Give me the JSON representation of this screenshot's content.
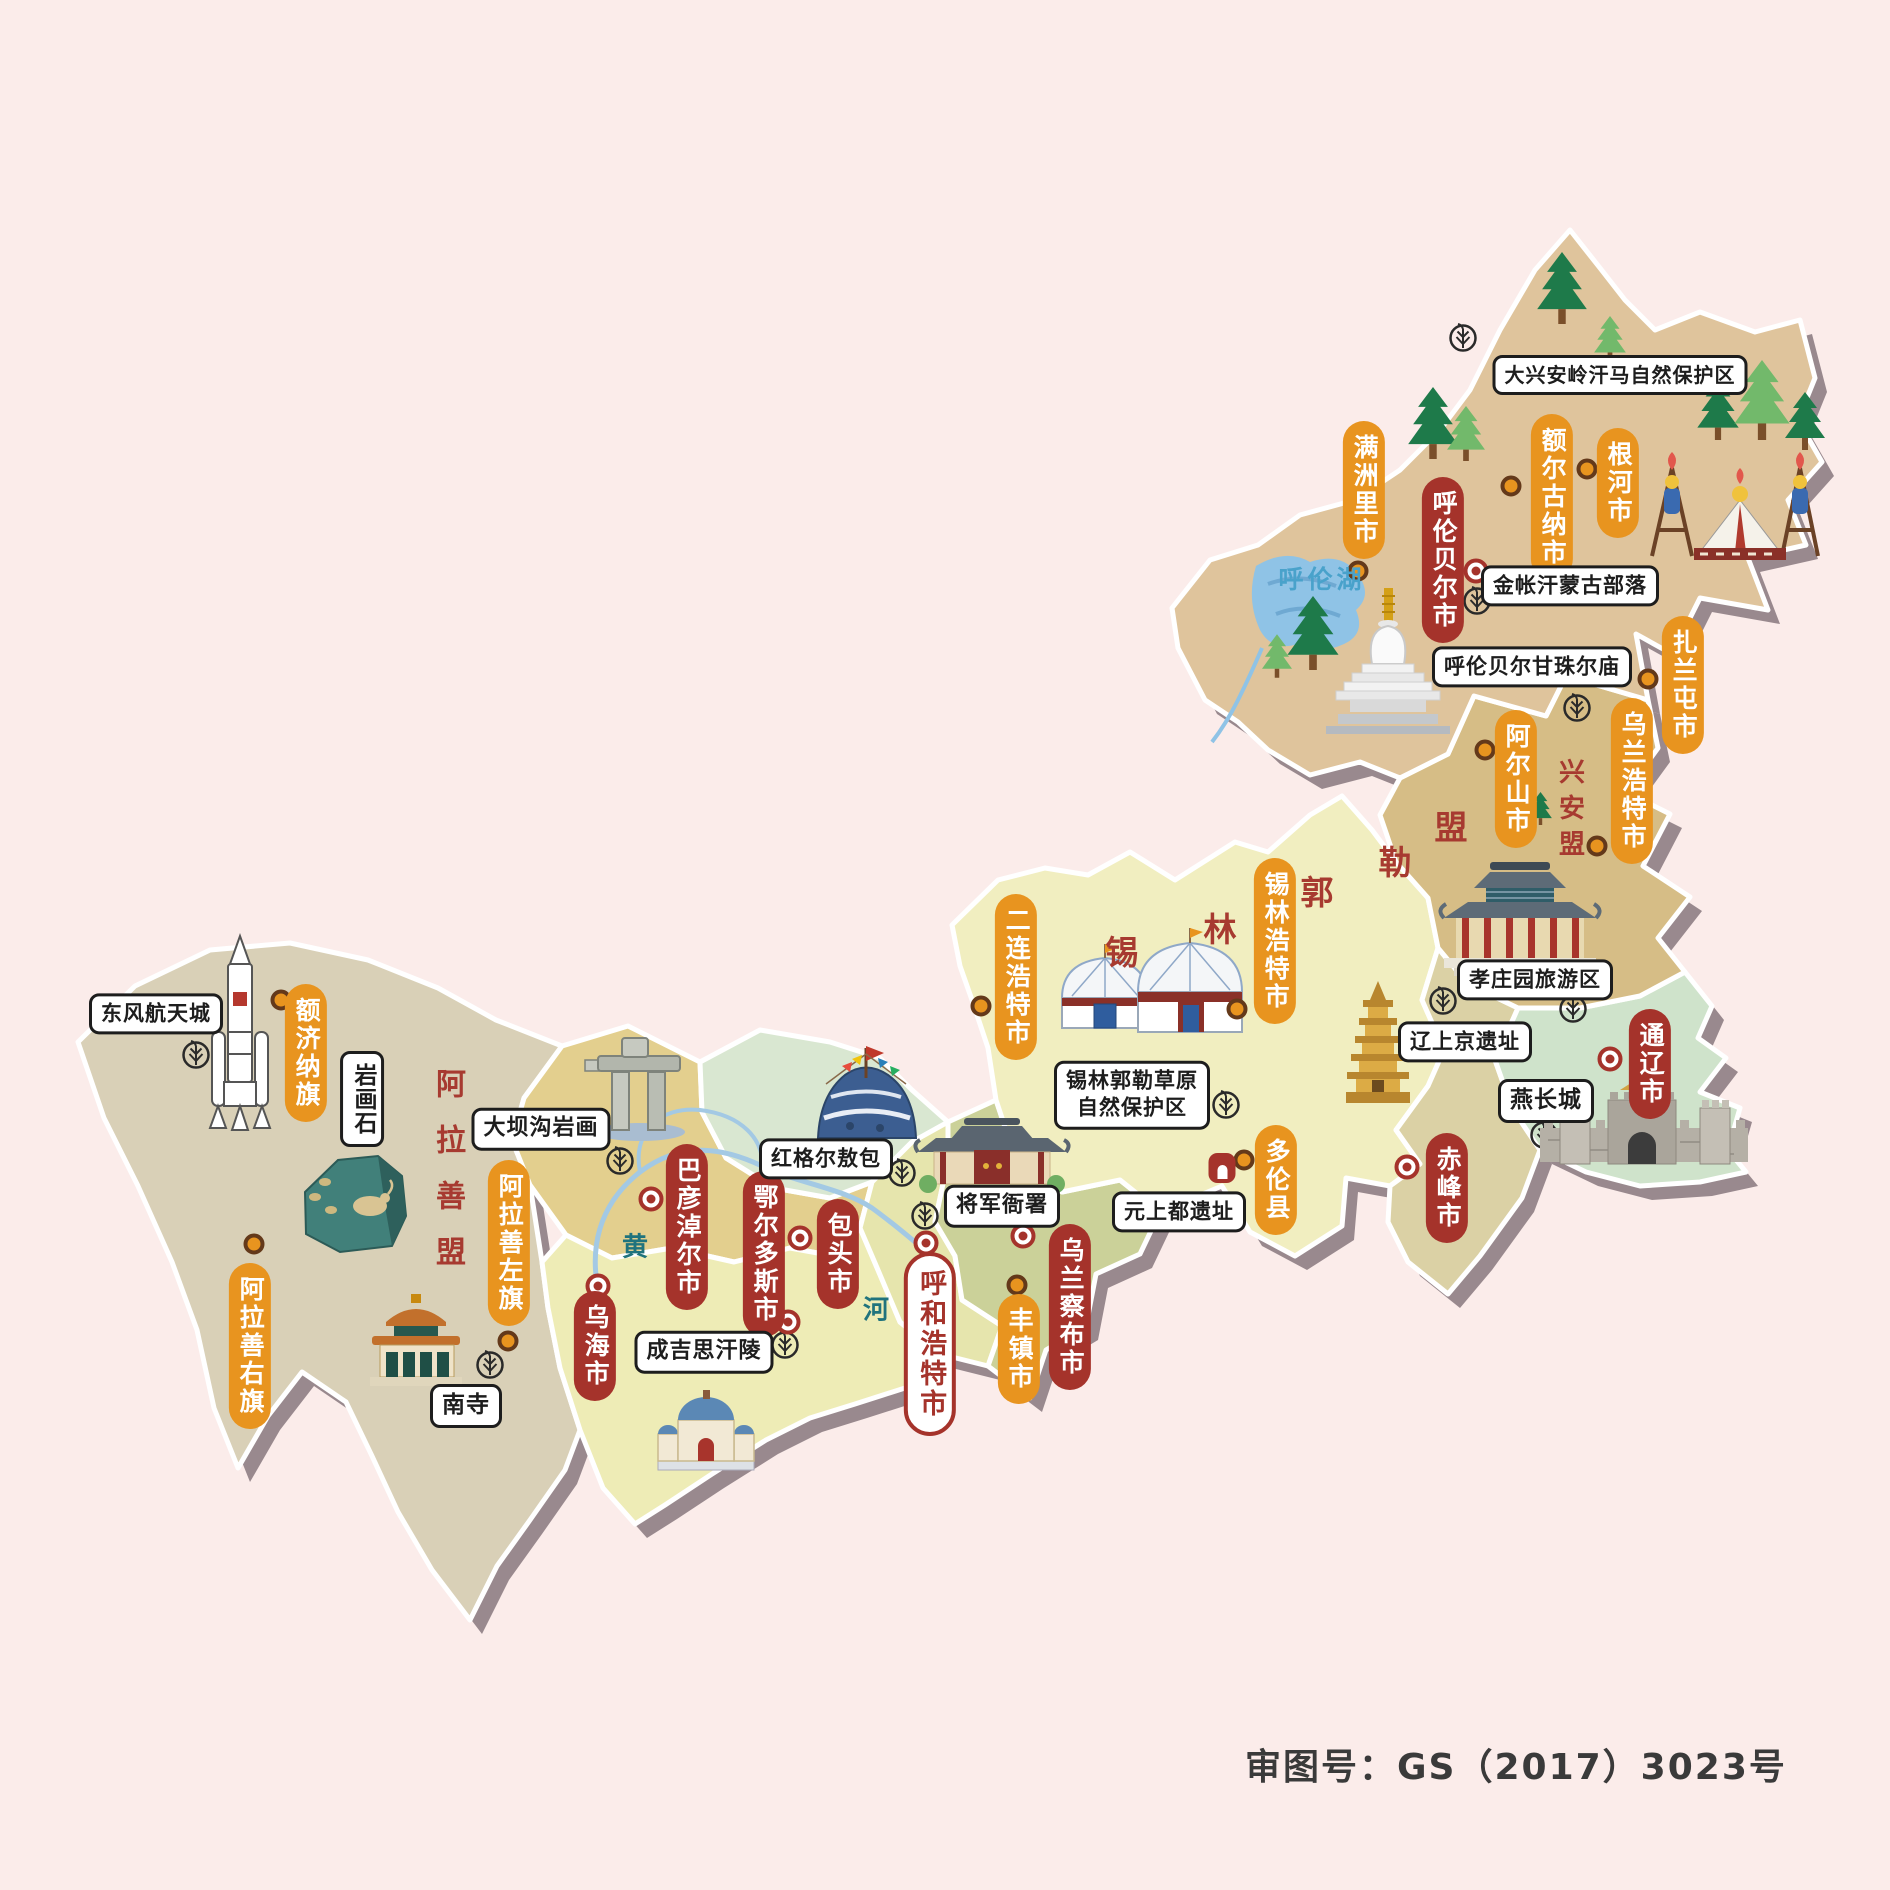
{
  "palette": {
    "bg": "#fbecea",
    "shadow": "#99898e",
    "pill_minor": "#e8941f",
    "pill_major": "#a5332b",
    "region_label": "#a73a30",
    "r_hulunbuir": "#dfc49c",
    "r_xingan": "#d6bd86",
    "r_xilinguole": "#f1eec0",
    "r_tongliao": "#cfe3cb",
    "r_chifeng": "#dbd1a5",
    "r_ulanqab": "#cbd199",
    "r_hohhot": "#e6e5ad",
    "r_midgreen": "#d9e7d1",
    "r_bayannur": "#e3cf8e",
    "r_ordos": "#eeecb6",
    "r_alxa": "#d9d0b7"
  },
  "footer": {
    "text": "审图号：GS（2017）3023号"
  },
  "labels": [
    {
      "id": "city-pill-manzhouli",
      "text": "满洲里市",
      "kind": "pill-minor",
      "x": 1364,
      "y": 490
    },
    {
      "id": "city-pill-eerguna",
      "text": "额尔古纳市",
      "kind": "pill-minor",
      "x": 1552,
      "y": 497
    },
    {
      "id": "city-pill-genhe",
      "text": "根河市",
      "kind": "pill-minor",
      "x": 1618,
      "y": 483
    },
    {
      "id": "city-pill-hulunbeier",
      "text": "呼伦贝尔市",
      "kind": "pill-major",
      "x": 1443,
      "y": 560
    },
    {
      "id": "city-pill-zhalantun",
      "text": "扎兰屯市",
      "kind": "pill-minor",
      "x": 1683,
      "y": 685
    },
    {
      "id": "city-pill-wulanhaote",
      "text": "乌兰浩特市",
      "kind": "pill-minor",
      "x": 1632,
      "y": 781
    },
    {
      "id": "city-pill-aershan",
      "text": "阿尔山市",
      "kind": "pill-minor",
      "x": 1516,
      "y": 779
    },
    {
      "id": "city-pill-erlianhaote",
      "text": "二连浩特市",
      "kind": "pill-minor",
      "x": 1016,
      "y": 977
    },
    {
      "id": "city-pill-xilinhaote",
      "text": "锡林浩特市",
      "kind": "pill-minor",
      "x": 1275,
      "y": 941
    },
    {
      "id": "city-pill-duolun",
      "text": "多伦县",
      "kind": "pill-minor",
      "x": 1276,
      "y": 1180
    },
    {
      "id": "city-pill-fengzhen",
      "text": "丰镇市",
      "kind": "pill-minor",
      "x": 1019,
      "y": 1349
    },
    {
      "id": "city-pill-ejina",
      "text": "额济纳旗",
      "kind": "pill-minor",
      "x": 306,
      "y": 1053
    },
    {
      "id": "city-pill-alashanzuoqi",
      "text": "阿拉善左旗",
      "kind": "pill-minor",
      "x": 509,
      "y": 1243
    },
    {
      "id": "city-pill-alashanyouqi",
      "text": "阿拉善右旗",
      "kind": "pill-minor",
      "x": 250,
      "y": 1346
    },
    {
      "id": "city-pill-wuhai",
      "text": "乌海市",
      "kind": "pill-major",
      "x": 595,
      "y": 1346
    },
    {
      "id": "city-pill-bayannaoer",
      "text": "巴彦淖尔市",
      "kind": "pill-major",
      "x": 687,
      "y": 1227
    },
    {
      "id": "city-pill-eerduosi",
      "text": "鄂尔多斯市",
      "kind": "pill-major",
      "x": 764,
      "y": 1254
    },
    {
      "id": "city-pill-baotou",
      "text": "包头市",
      "kind": "pill-major",
      "x": 838,
      "y": 1254
    },
    {
      "id": "city-pill-wulanchabu",
      "text": "乌兰察布市",
      "kind": "pill-major",
      "x": 1070,
      "y": 1307
    },
    {
      "id": "city-pill-chifeng",
      "text": "赤峰市",
      "kind": "pill-major",
      "x": 1447,
      "y": 1188
    },
    {
      "id": "city-pill-tongliao",
      "text": "通辽市",
      "kind": "pill-major",
      "x": 1650,
      "y": 1064
    },
    {
      "id": "city-pill-huhehaote",
      "text": "呼和浩特市",
      "kind": "pill-capital",
      "x": 930,
      "y": 1344
    },
    {
      "id": "site-box-hanma-reserve",
      "text": "大兴安岭汗马自然保护区",
      "kind": "box",
      "x": 1620,
      "y": 375,
      "size": 20
    },
    {
      "id": "site-box-jinzhanghan",
      "text": "金帐汗蒙古部落",
      "kind": "box",
      "x": 1570,
      "y": 586,
      "size": 21
    },
    {
      "id": "site-box-ganzhuer-temple",
      "text": "呼伦贝尔甘珠尔庙",
      "kind": "box",
      "x": 1532,
      "y": 667,
      "size": 21
    },
    {
      "id": "site-box-xiaozhuangyuan",
      "text": "孝庄园旅游区",
      "kind": "box",
      "x": 1535,
      "y": 980,
      "size": 21
    },
    {
      "id": "site-box-liaoshangjing",
      "text": "辽上京遗址",
      "kind": "box",
      "x": 1465,
      "y": 1042,
      "size": 21
    },
    {
      "id": "site-box-yanchangcheng",
      "text": "燕长城",
      "kind": "box",
      "x": 1546,
      "y": 1101
    },
    {
      "id": "site-box-ximeng-grassland",
      "text": "锡林郭勒草原\n自然保护区",
      "kind": "box",
      "x": 1132,
      "y": 1095,
      "size": 21
    },
    {
      "id": "site-box-yuanshangdu",
      "text": "元上都遗址",
      "kind": "box",
      "x": 1179,
      "y": 1212,
      "size": 21
    },
    {
      "id": "site-box-jiangjunyashu",
      "text": "将军衙署",
      "kind": "box",
      "x": 1002,
      "y": 1206,
      "size": 22
    },
    {
      "id": "site-box-honggeer-aobao",
      "text": "红格尔敖包",
      "kind": "box",
      "x": 826,
      "y": 1159,
      "size": 21
    },
    {
      "id": "site-box-chengjisihanling",
      "text": "成吉思汗陵",
      "kind": "box",
      "x": 704,
      "y": 1352,
      "size": 22
    },
    {
      "id": "site-box-nansi",
      "text": "南寺",
      "kind": "box",
      "x": 466,
      "y": 1406
    },
    {
      "id": "site-box-dabagou-rock-art",
      "text": "大坝沟岩画",
      "kind": "box",
      "x": 541,
      "y": 1129,
      "size": 22
    },
    {
      "id": "site-box-dongfeng-space-city",
      "text": "东风航天城",
      "kind": "box",
      "x": 156,
      "y": 1014,
      "size": 21
    },
    {
      "id": "site-box-yanhuashi",
      "text": "岩画石",
      "kind": "box-v",
      "x": 362,
      "y": 1099
    },
    {
      "id": "region-label-alashanmeng",
      "text": "阿拉善盟",
      "kind": "region-v",
      "x": 447,
      "y": 1180,
      "size": 30,
      "gap": 26
    },
    {
      "id": "region-label-xinganmeng",
      "text": "兴安盟",
      "kind": "region-v",
      "x": 1570,
      "y": 812,
      "size": 26,
      "gap": 10
    },
    {
      "id": "region-char-xi",
      "text": "锡",
      "kind": "region-char",
      "x": 1122,
      "y": 950
    },
    {
      "id": "region-char-lin",
      "text": "林",
      "kind": "region-char",
      "x": 1220,
      "y": 927
    },
    {
      "id": "region-char-guo",
      "text": "郭",
      "kind": "region-char",
      "x": 1317,
      "y": 890
    },
    {
      "id": "region-char-le",
      "text": "勒",
      "kind": "region-char",
      "x": 1395,
      "y": 860
    },
    {
      "id": "region-char-meng",
      "text": "盟",
      "kind": "region-char",
      "x": 1451,
      "y": 825
    },
    {
      "id": "water-label-hulun-lake",
      "text": "呼伦湖",
      "kind": "water",
      "x": 1322,
      "y": 578,
      "color": "#49a2cb",
      "size": 25
    },
    {
      "id": "water-label-huang",
      "text": "黄",
      "kind": "water",
      "x": 637,
      "y": 1245,
      "color": "#20737d",
      "size": 26
    },
    {
      "id": "water-label-he",
      "text": "河",
      "kind": "water",
      "x": 878,
      "y": 1308,
      "color": "#20737d",
      "size": 26
    }
  ],
  "markers": [
    {
      "id": "dot-manzhouli",
      "kind": "dot",
      "x": 1358,
      "y": 571
    },
    {
      "id": "dot-eerguna",
      "kind": "dot",
      "x": 1511,
      "y": 486
    },
    {
      "id": "dot-genhe",
      "kind": "dot",
      "x": 1587,
      "y": 469
    },
    {
      "id": "dot-zhalantun",
      "kind": "dot",
      "x": 1648,
      "y": 679
    },
    {
      "id": "dot-wulanhaote",
      "kind": "dot",
      "x": 1597,
      "y": 846
    },
    {
      "id": "dot-aershan",
      "kind": "dot",
      "x": 1485,
      "y": 750
    },
    {
      "id": "dot-xilinhaote",
      "kind": "dot",
      "x": 1237,
      "y": 1009
    },
    {
      "id": "dot-erlianhaote",
      "kind": "dot",
      "x": 981,
      "y": 1006
    },
    {
      "id": "dot-duolun",
      "kind": "dot",
      "x": 1244,
      "y": 1160
    },
    {
      "id": "dot-fengzhen",
      "kind": "dot",
      "x": 1017,
      "y": 1285
    },
    {
      "id": "dot-ejina",
      "kind": "dot",
      "x": 281,
      "y": 1000
    },
    {
      "id": "dot-alashanzuoqi",
      "kind": "dot",
      "x": 508,
      "y": 1341
    },
    {
      "id": "dot-alashanyouqi",
      "kind": "dot",
      "x": 254,
      "y": 1244
    },
    {
      "id": "capital-marker-hulunbeier",
      "kind": "cap",
      "x": 1476,
      "y": 571
    },
    {
      "id": "capital-marker-chifeng",
      "kind": "cap",
      "x": 1407,
      "y": 1167
    },
    {
      "id": "capital-marker-tongliao",
      "kind": "cap",
      "x": 1610,
      "y": 1059
    },
    {
      "id": "capital-marker-wulanchabu",
      "kind": "cap",
      "x": 1023,
      "y": 1236
    },
    {
      "id": "capital-marker-huhehaote",
      "kind": "cap",
      "x": 926,
      "y": 1243
    },
    {
      "id": "capital-marker-bayannaoer",
      "kind": "cap",
      "x": 651,
      "y": 1199
    },
    {
      "id": "capital-marker-baotou",
      "kind": "cap",
      "x": 800,
      "y": 1238
    },
    {
      "id": "capital-marker-eerduosi",
      "kind": "cap",
      "x": 788,
      "y": 1322
    },
    {
      "id": "capital-marker-wuhai",
      "kind": "cap",
      "x": 598,
      "y": 1286
    },
    {
      "id": "site-icon-yuanshangdu",
      "kind": "site",
      "x": 1222,
      "y": 1168
    }
  ]
}
